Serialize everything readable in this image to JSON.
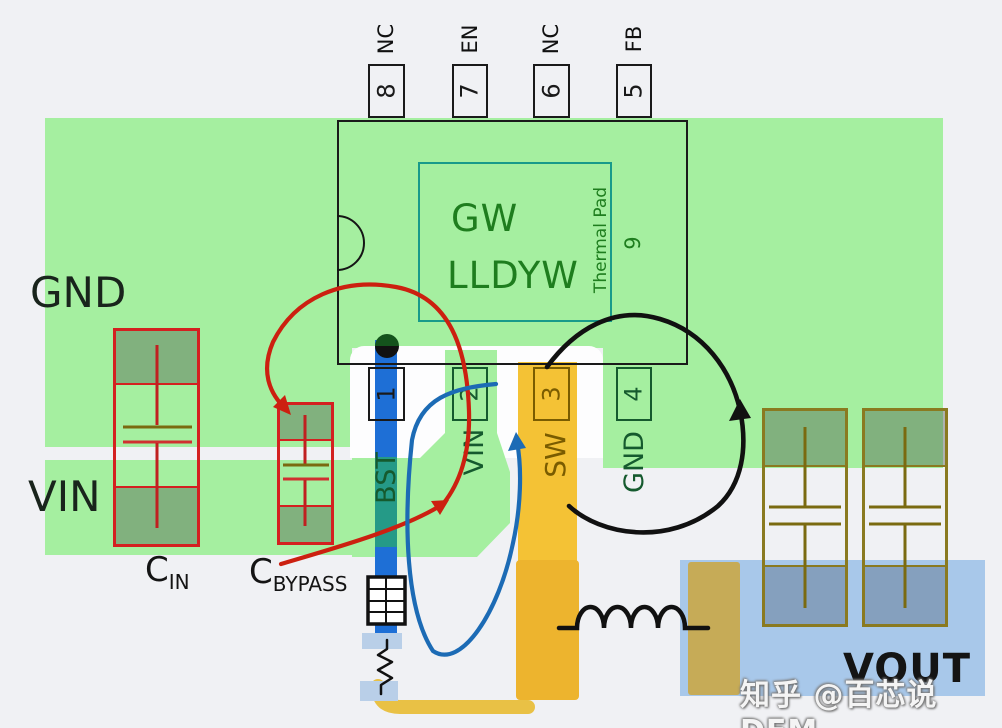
{
  "diagram_type": "buck-converter PCB layout with current loops",
  "labels": {
    "gnd": "GND",
    "vin": "VIN",
    "vout": "VOUT",
    "cin_c": "C",
    "cin_sub": "IN",
    "cbyp_c": "C",
    "cbyp_sub": "BYPASS"
  },
  "chip": {
    "line1": "GW",
    "line2": "LLDYW",
    "thermal_pad": "Thermal Pad",
    "pad_number": "9"
  },
  "pins_top": [
    {
      "number": "8",
      "name": "NC"
    },
    {
      "number": "7",
      "name": "EN"
    },
    {
      "number": "6",
      "name": "NC"
    },
    {
      "number": "5",
      "name": "FB"
    }
  ],
  "pins_bottom": [
    {
      "number": "1",
      "name": "BST"
    },
    {
      "number": "2",
      "name": "VIN"
    },
    {
      "number": "3",
      "name": "SW"
    },
    {
      "number": "4",
      "name": "GND"
    }
  ],
  "watermark": {
    "text": "知乎 @百芯说DFM"
  },
  "colors": {
    "copper_green": "#a5efa0",
    "vout_blue": "#a8c8ea",
    "sw_yellow": "#f4c235",
    "bst_blue": "#1e6fd6",
    "bst_teal": "#259a87",
    "cap_outline_red": "#d42020",
    "cap_outline_olive": "#8a7a20",
    "hot_loop_red": "#cc2010",
    "bst_loop_blue": "#1c6bb5",
    "sw_loop_black": "#111111",
    "chip_marking_green": "#1e7d1e"
  }
}
